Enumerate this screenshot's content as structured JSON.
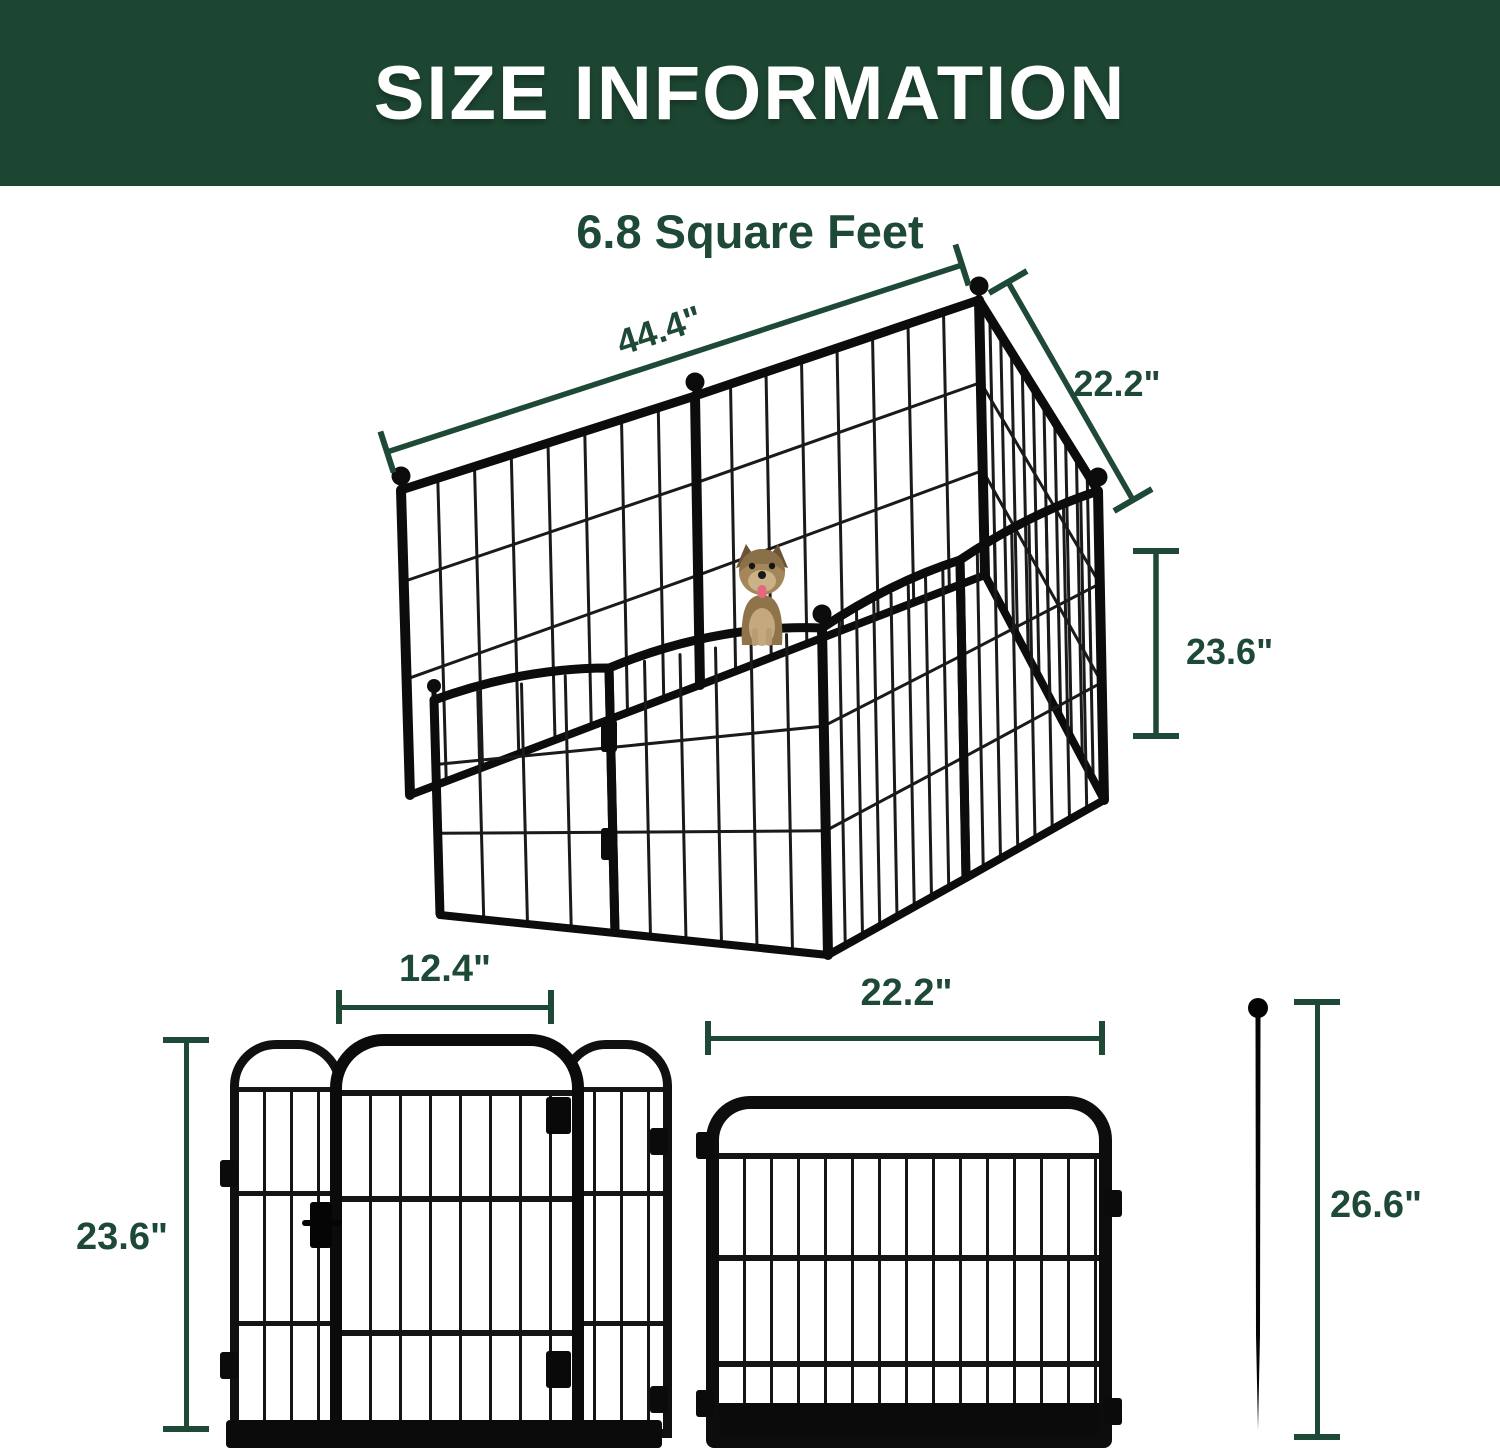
{
  "header": {
    "title": "SIZE INFORMATION"
  },
  "area": {
    "label": "6.8 Square Feet"
  },
  "iso": {
    "length": "44.4\"",
    "depth": "22.2\"",
    "height": "23.6\"",
    "dog": "yorkshire-terrier"
  },
  "door_panel": {
    "door_width": "12.4\"",
    "height": "23.6\""
  },
  "panel": {
    "width": "22.2\""
  },
  "stake": {
    "height": "26.6\""
  },
  "colors": {
    "banner": "#1d4632",
    "accent": "#1e4937",
    "metal": "#0d0d0d"
  }
}
